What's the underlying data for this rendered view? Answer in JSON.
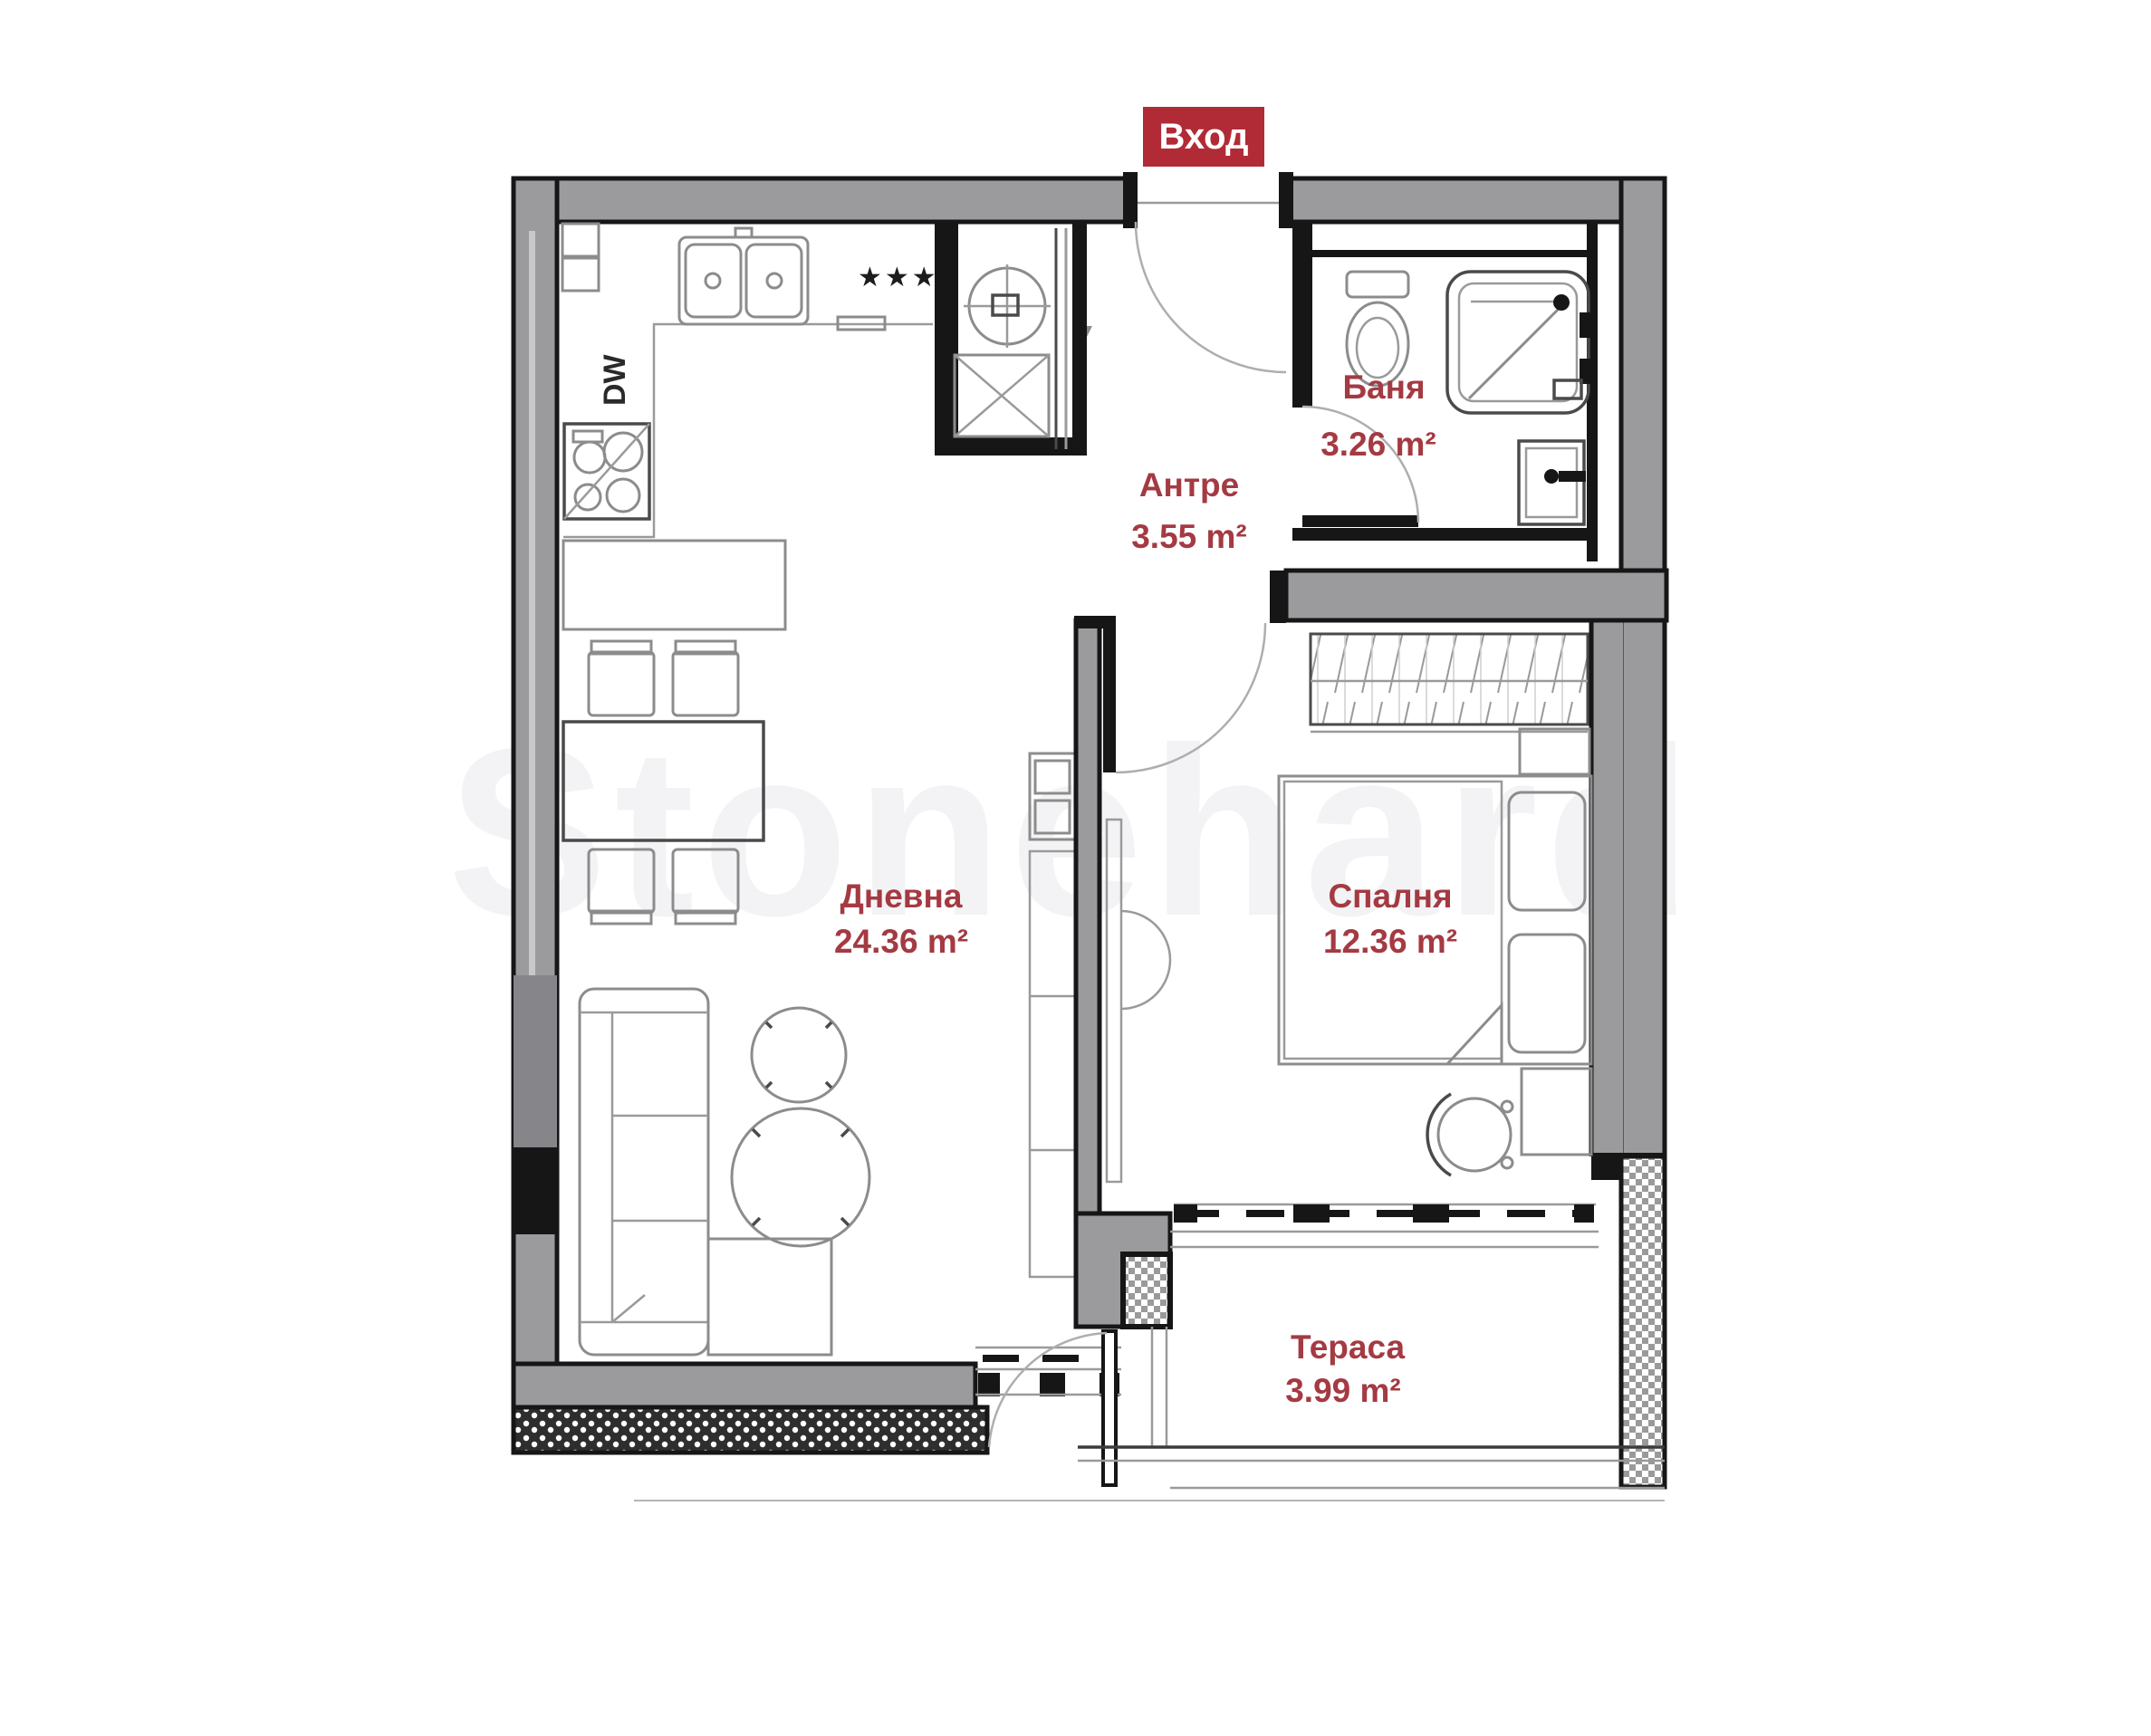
{
  "entrance_badge": {
    "label": "Вход"
  },
  "rooms": [
    {
      "id": "bathroom",
      "name": "Баня",
      "area": "3.26 m²"
    },
    {
      "id": "hallway",
      "name": "Антре",
      "area": "3.55 m²"
    },
    {
      "id": "living",
      "name": "Дневна",
      "area": "24.36 m²"
    },
    {
      "id": "bedroom",
      "name": "Спалня",
      "area": "12.36 m²"
    },
    {
      "id": "terrace",
      "name": "Тераса",
      "area": "3.99 m²"
    }
  ],
  "annotations": {
    "dishwasher_label": "DW",
    "hob_stars": "★★★"
  },
  "watermark": {
    "text": "Stonehard"
  },
  "colors": {
    "badge_bg": "#b12b36",
    "label_red": "#a43a42",
    "wall_gray": "#9b9b9e"
  }
}
